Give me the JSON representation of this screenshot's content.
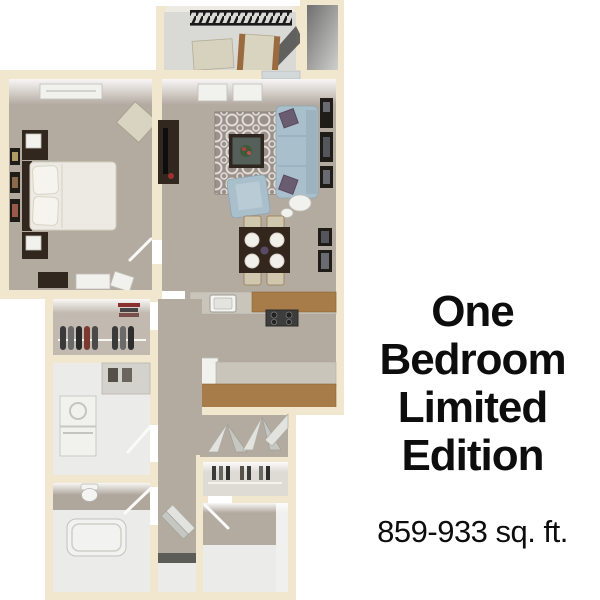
{
  "caption": {
    "title_lines": [
      "One",
      "Bedroom",
      "Limited",
      "Edition"
    ],
    "sqft": "859-933 sq. ft."
  },
  "floorplan": {
    "description": "3D top-down rendering of a one bedroom apartment floor plan",
    "rooms": [
      "balcony",
      "storage-closet",
      "bedroom",
      "living-room",
      "dining-area",
      "kitchen",
      "walk-in-closet",
      "laundry-room",
      "bathroom",
      "hallway",
      "linen-closet",
      "entry-room"
    ],
    "colors": {
      "background": "#ffffff",
      "text": "#0d0d0d",
      "wall": "#f0e7ce",
      "carpet": "#b3aaa0",
      "carpet_light": "#c2bab0",
      "hard_floor": "#ebebe9",
      "balcony_floor": "#d9d9d6",
      "sofa_blue": "#a9bfcc",
      "wood": "#a87c48",
      "dark_furniture": "#32271e",
      "railing": "#1a1a1a"
    }
  }
}
